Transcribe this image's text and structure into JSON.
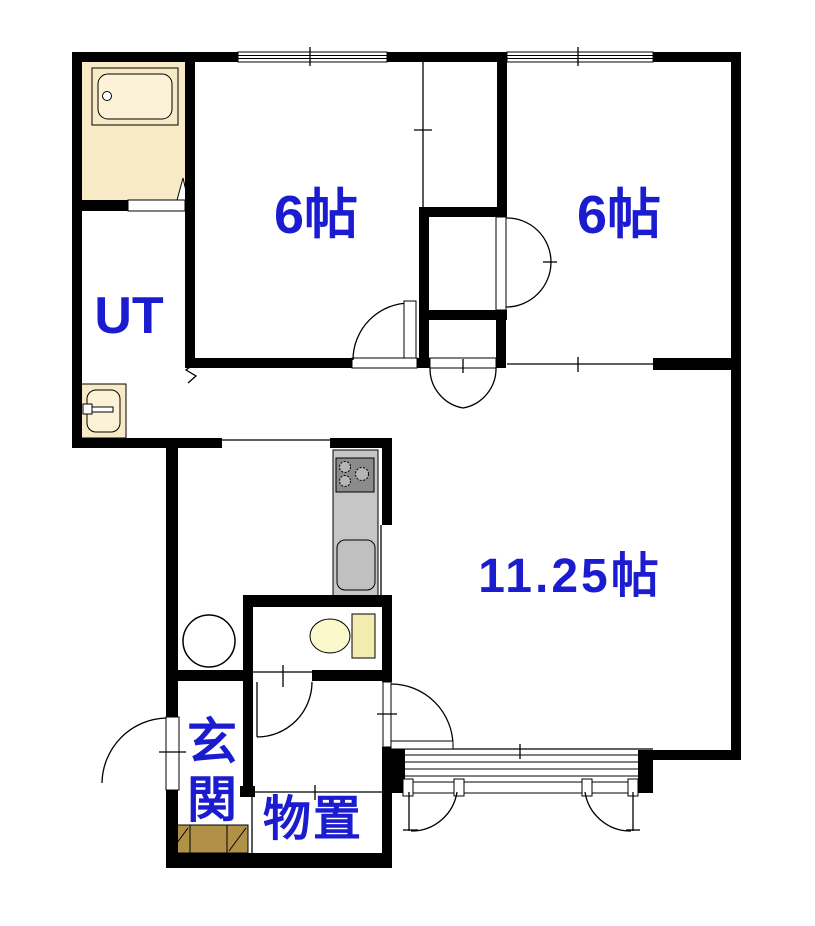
{
  "document": {
    "type": "apartment-floor-plan",
    "orientation": "top-down"
  },
  "rooms": {
    "bedroom_left": {
      "label": "6帖"
    },
    "bedroom_right": {
      "label": "6帖"
    },
    "utility": {
      "label": "UT"
    },
    "living": {
      "label": "11.25帖"
    },
    "entrance": {
      "label": "玄関"
    },
    "storage": {
      "label": "物置"
    }
  },
  "fixtures": [
    "bathtub",
    "washbasin",
    "washing-machine-space",
    "kitchen-counter",
    "stove-burners",
    "kitchen-sink",
    "toilet",
    "entrance-step",
    "closet-double-doors",
    "window-shutter-doors"
  ],
  "palette": {
    "label_blue": "#1b1bcf",
    "bathroom_cream": "#f7eac5",
    "bathtub_inner": "#fbf2d7",
    "toilet_bowl_yellow": "#fbf8cc",
    "toilet_tank_yellow": "#f2ecae",
    "kitchen_counter_gray": "#c6c6c6",
    "stove_gray": "#8b8b8b",
    "entrance_step_tan": "#b19148",
    "wall_black": "#000000"
  }
}
